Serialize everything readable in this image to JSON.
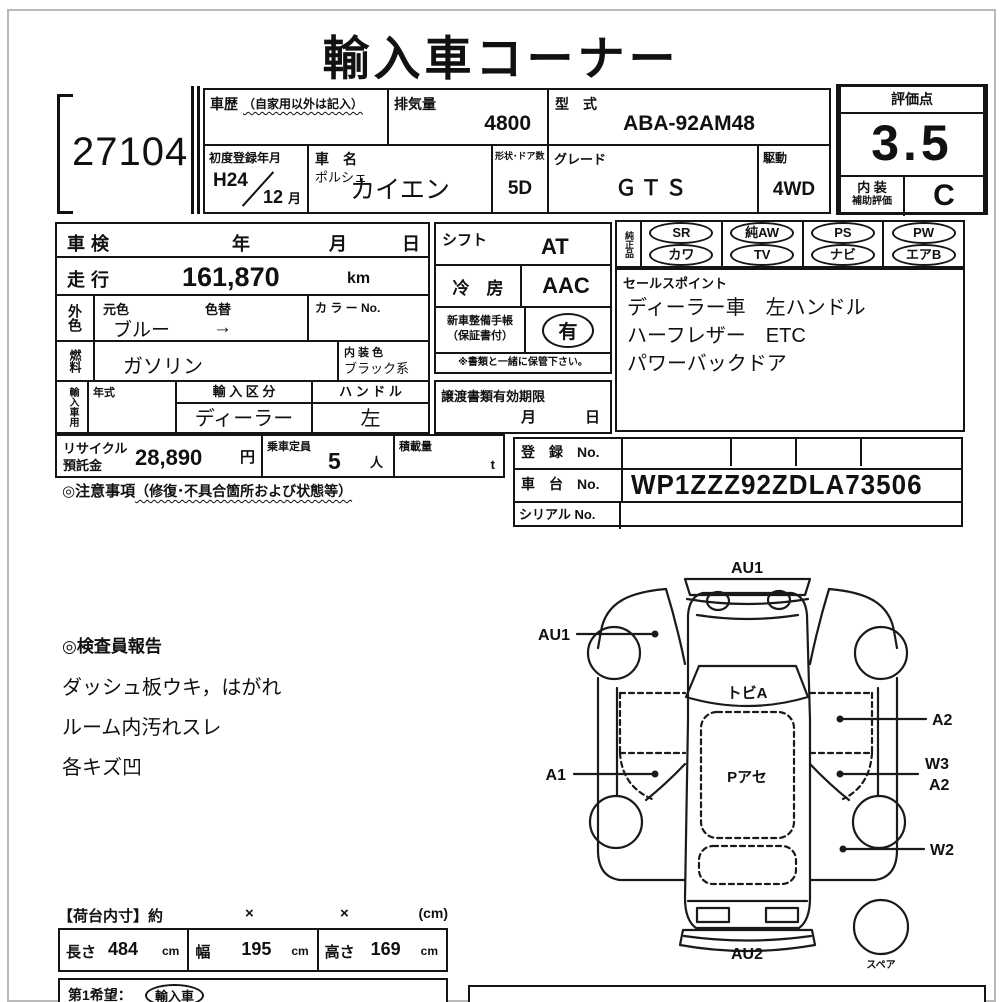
{
  "title": "輸入車コーナー",
  "lot_no": "27104",
  "header": {
    "car_history_label": "車歴",
    "car_history_note": "（自家用以外は記入）",
    "displacement_label": "排気量",
    "displacement": "4800",
    "model_code_label": "型　式",
    "model_code": "ABA-92AM48",
    "first_reg_label": "初度登録年月",
    "first_reg_year": "H24",
    "first_reg_month": "12",
    "month_suffix": "月",
    "car_name_label": "車　名",
    "maker": "ポルシェ",
    "car_name": "カイエン",
    "doors_label": "形状･ドア数",
    "doors": "5D",
    "grade_label": "グレード",
    "grade": "ＧＴＳ",
    "drive_label": "駆動",
    "drive": "4WD"
  },
  "rating": {
    "score_label": "評価点",
    "score": "3.5",
    "interior_label": "内 装",
    "interior_sub_label": "補助評価",
    "interior_grade": "C"
  },
  "left_table": {
    "shaken_label": "車検",
    "year": "年",
    "month": "月",
    "day": "日",
    "mileage_label": "走行",
    "mileage": "161,870",
    "mileage_unit": "km",
    "ext_color_label": "外色",
    "orig_color_label": "元色",
    "color_change_label": "色替",
    "color": "ブルー",
    "color_arrow": "→",
    "color_no_label": "カ ラ ー No.",
    "fuel_label": "燃料",
    "fuel": "ガソリン",
    "interior_color_label": "内 装 色",
    "interior_color": "ブラック系",
    "import_label": "輸入車用",
    "year_model_label": "年式",
    "import_type_label": "輸 入 区 分",
    "import_type": "ディーラー",
    "handle_label": "ハ ン ド ル",
    "handle": "左"
  },
  "middle": {
    "shift_label": "シフト",
    "shift": "AT",
    "ac_label": "冷　房",
    "ac": "AAC",
    "maintenance_label": "新車整備手帳",
    "maintenance_sub": "（保証書付）",
    "maintenance": "有",
    "keep_note": "※書類と一緒に保管下さい。",
    "transfer_label": "譲渡書類有効期限",
    "transfer_month": "月",
    "transfer_day": "日"
  },
  "equipment": {
    "label": "純正品",
    "row1": [
      "SR",
      "純AW",
      "PS",
      "PW"
    ],
    "row2": [
      "カワ",
      "TV",
      "ナビ",
      "エアB"
    ]
  },
  "sales_points": {
    "label": "セールスポイント",
    "lines": [
      "ディーラー車　左ハンドル",
      "ハーフレザー　ETC",
      "パワーバックドア"
    ]
  },
  "bottom_row": {
    "recycle_label1": "リサイクル",
    "recycle_label2": "預託金",
    "recycle_amount": "28,890",
    "yen": "円",
    "capacity_label": "乗車定員",
    "capacity": "5",
    "capacity_unit": "人",
    "load_label": "積載量",
    "load_unit": "t"
  },
  "registration": {
    "reg_label": "登　録　No.",
    "chassis_label": "車　台　No.",
    "chassis_no": "WP1ZZZ92ZDLA73506",
    "serial_label": "シリアル No."
  },
  "notes": {
    "caution_title": "◎注意事項",
    "caution_note": "（修復･不具合箇所および状態等）",
    "inspector_title": "◎検査員報告",
    "inspector_lines": [
      "ダッシュ板ウキ，はがれ",
      "ルーム内汚れスレ",
      "各キズ凹"
    ]
  },
  "diagram": {
    "labels": {
      "front": "AU1",
      "left_front": "AU1",
      "windshield": "トビA",
      "roof": "Pアセ",
      "left_door": "A1",
      "right_front": "A2",
      "right_rear_1": "W3",
      "right_rear_2": "A2",
      "right_quarter": "W2",
      "rear": "AU2",
      "spare": "スペア"
    }
  },
  "dimensions": {
    "title": "【荷台内寸】約",
    "x1": "×",
    "x2": "×",
    "unit": "(cm)",
    "length_label": "長さ",
    "length": "484",
    "length_unit": "cm",
    "width_label": "幅",
    "width": "195",
    "width_unit": "cm",
    "height_label": "高さ",
    "height": "169",
    "height_unit": "cm",
    "wish_label": "第1希望：",
    "wish_value": "輸入車"
  }
}
